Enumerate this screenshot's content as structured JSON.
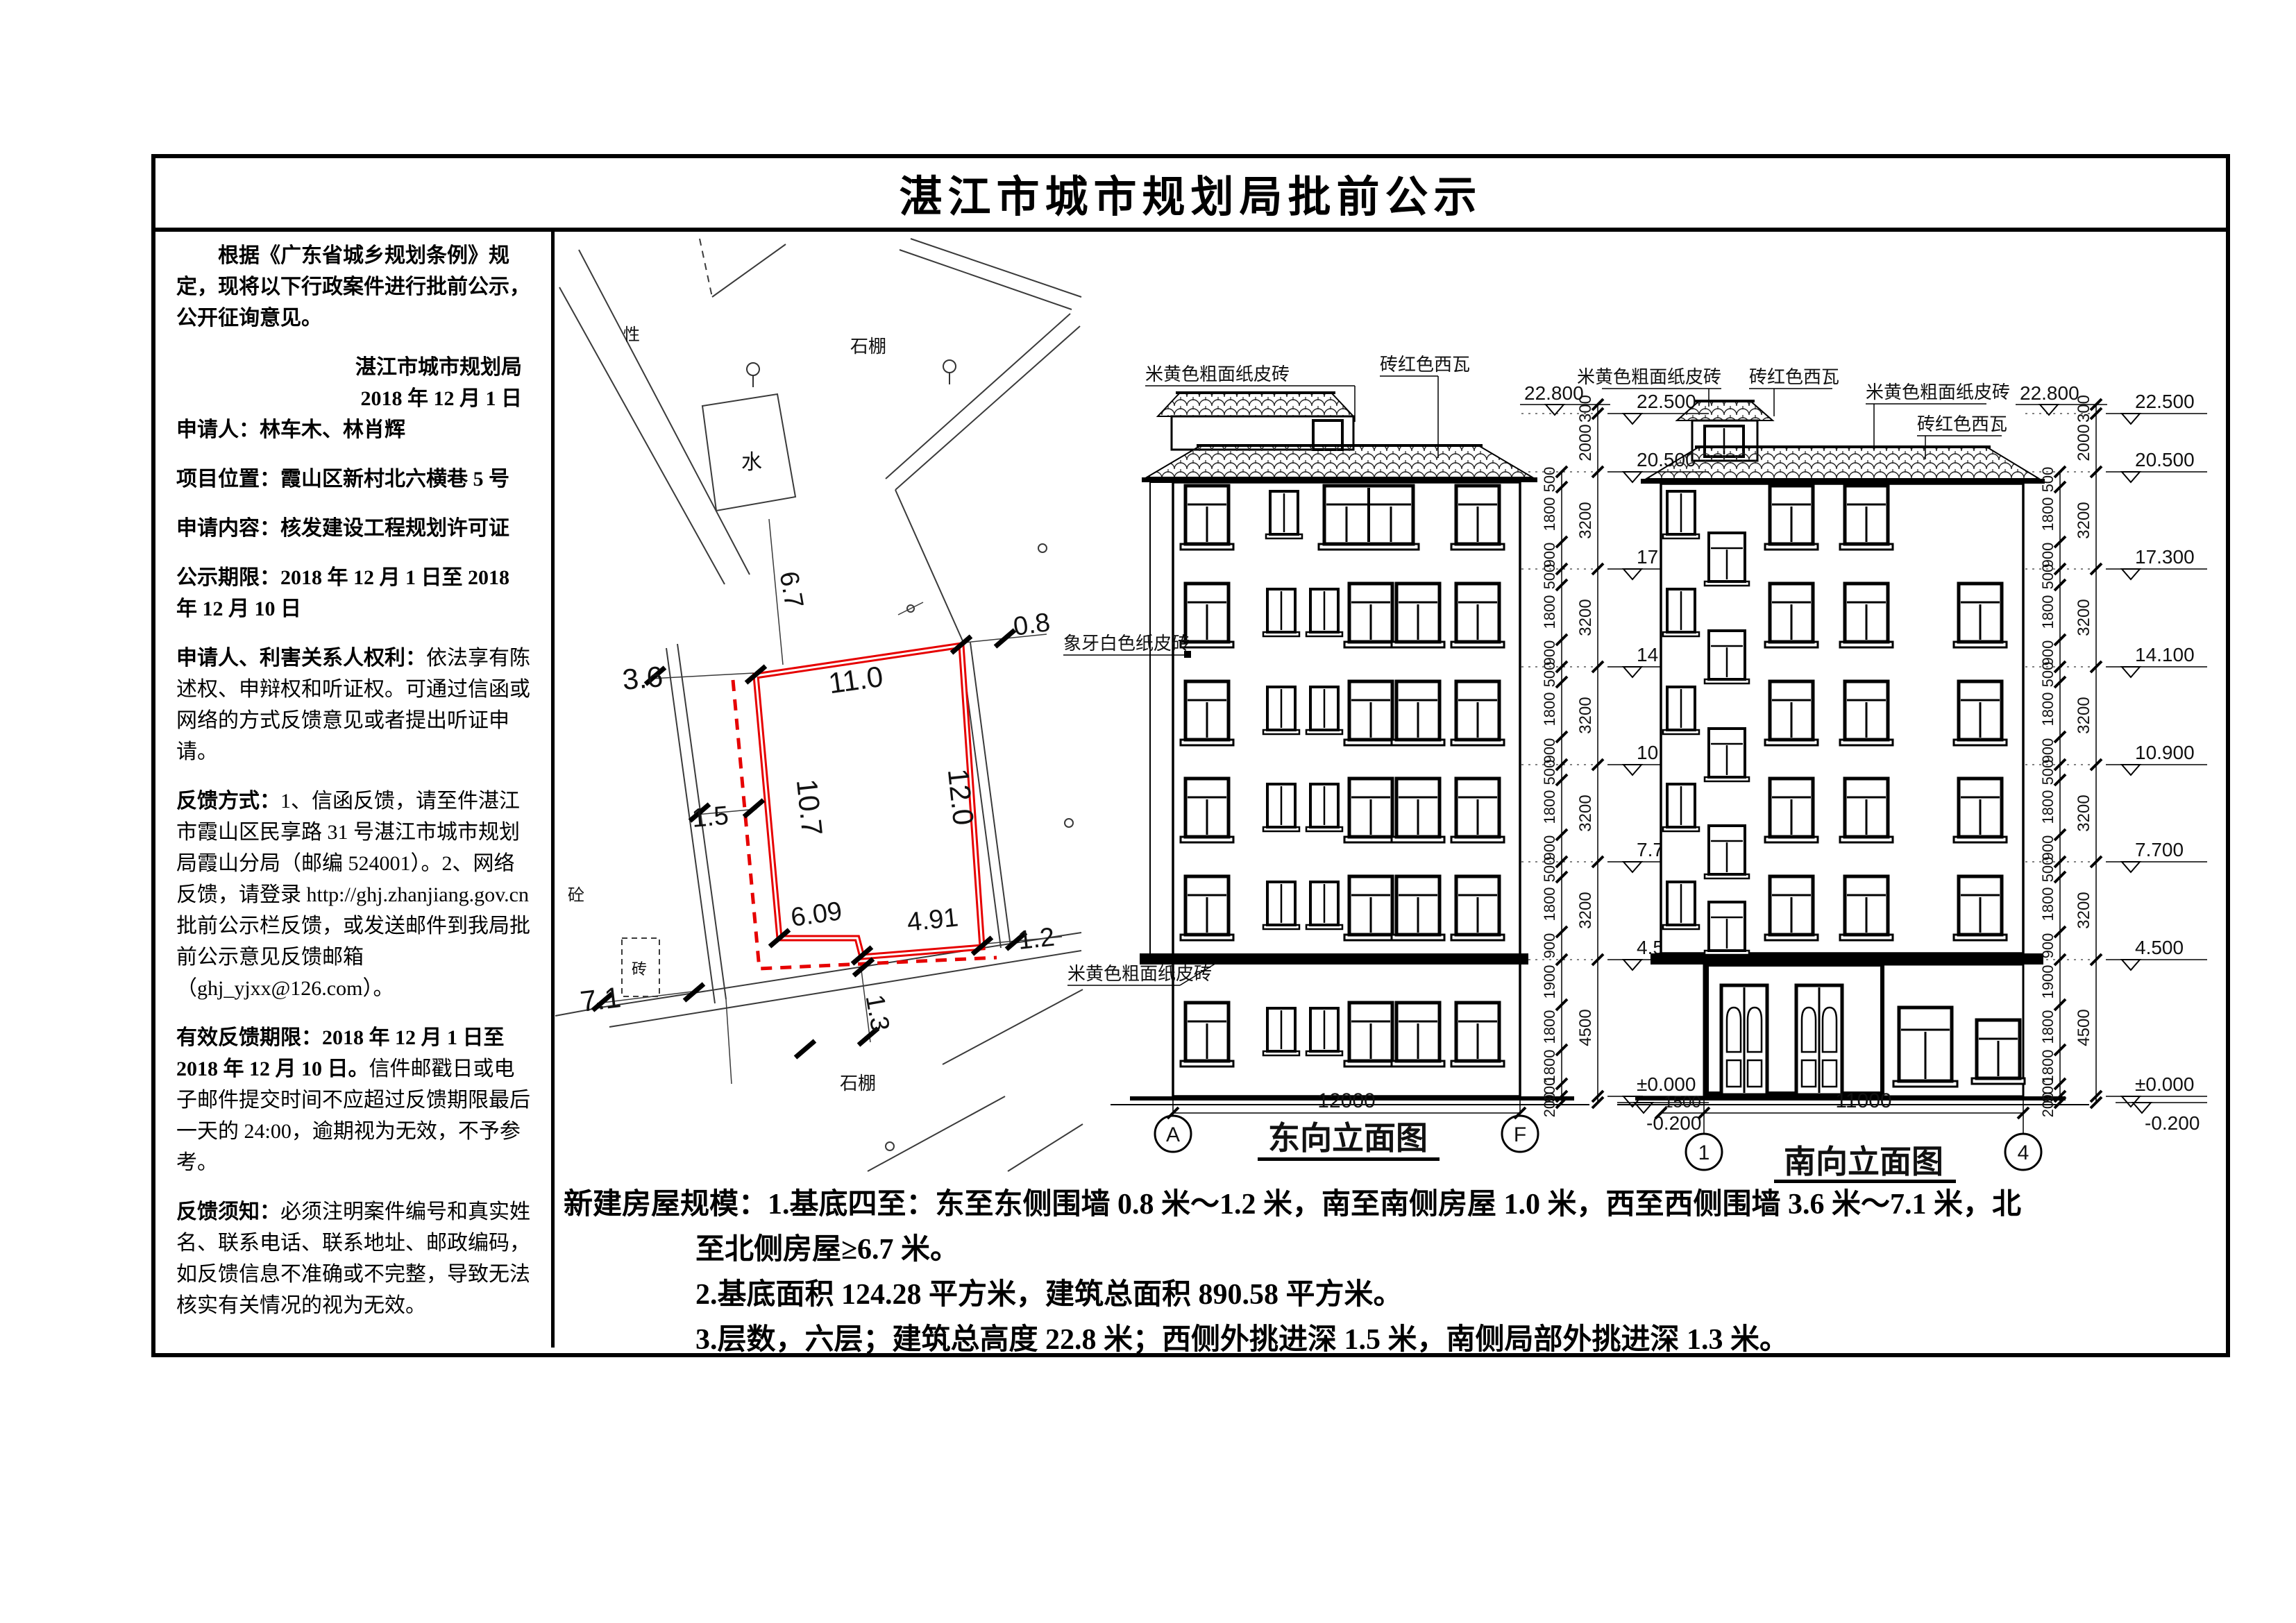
{
  "title": "湛江市城市规划局批前公示",
  "left_panel": {
    "intro": "根据《广东省城乡规划条例》规定，现将以下行政案件进行批前公示，公开征询意见。",
    "agency": "湛江市城市规划局",
    "date": "2018 年 12 月 1 日",
    "applicant_label": "申请人：",
    "applicant": "林车木、林肖辉",
    "location_label": "项目位置：",
    "location": "霞山区新村北六横巷 5 号",
    "content_label": "申请内容：",
    "content": "核发建设工程规划许可证",
    "period_label": "公示期限：",
    "period": "2018 年 12 月 1 日至 2018 年 12 月 10 日",
    "rights_label": "申请人、利害关系人权利：",
    "rights": "依法享有陈述权、申辩权和听证权。可通过信函或网络的方式反馈意见或者提出听证申请。",
    "feedback_label": "反馈方式：",
    "feedback": "1、信函反馈，请至件湛江市霞山区民享路 31 号湛江市城市规划局霞山分局（邮编 524001）。2、网络反馈，请登录 http://ghj.zhanjiang.gov.cn 批前公示栏反馈，或发送邮件到我局批前公示意见反馈邮箱（ghj_yjxx@126.com）。",
    "valid_label": "有效反馈期限：",
    "valid_dates": "2018 年 12 月 1 日至 2018 年 12 月 10 日。",
    "valid_rest": "信件邮戳日或电子邮件提交时间不应超过反馈期限最后一天的 24:00，逾期视为无效，不予参考。",
    "notice_label": "反馈须知：",
    "notice": "必须注明案件编号和真实姓名、联系电话、联系地址、邮政编码，如反馈信息不准确或不完整，导致无法核实有关情况的视为无效。"
  },
  "bottom": {
    "line1": "新建房屋规模：1.基底四至：东至东侧围墙 0.8 米～1.2 米，南至南侧房屋 1.0 米，西至西侧围墙 3.6 米～7.1 米，北",
    "line2": "至北侧房屋≥6.7 米。",
    "line3": "2.基底面积 124.28 平方米，建筑总面积 890.58 平方米。",
    "line4": "3.层数，六层；建筑总高度 22.8 米；西侧外挑进深 1.5 米，南侧局部外挑进深 1.3 米。"
  },
  "site_plan": {
    "plot_color": "#e60000",
    "dims": {
      "north_side": "11.0",
      "east_side": "12.0",
      "west_side": "10.7",
      "south_left": "6.09",
      "south_right": "4.91",
      "north_gap": "6.7",
      "east_gap1": "0.8",
      "east_gap2": "1.2",
      "west_gap1": "3.6",
      "west_gap2": "1.5",
      "west_gap3": "7.1",
      "south_gap": "1.3"
    },
    "labels": {
      "pond": "水",
      "shed_top": "石棚",
      "shed_bottom": "石棚",
      "stake": "性",
      "concrete": "砼",
      "brick": "砖"
    }
  },
  "elevation_dims": {
    "top_level": "22.800",
    "levels": [
      "22.500",
      "20.500",
      "17.300",
      "14.100",
      "10.900",
      "7.700",
      "4.500",
      "±0.000",
      "-0.200"
    ],
    "storey": [
      "300",
      "2000",
      "3200",
      "3200",
      "3200",
      "3200",
      "3200",
      "4500"
    ],
    "win": [
      "500",
      "1800",
      "900",
      "500",
      "1800",
      "900",
      "500",
      "1800",
      "900",
      "500",
      "1800",
      "900",
      "500",
      "1800",
      "900",
      "1900",
      "1800",
      "1800",
      "900",
      "200"
    ]
  },
  "east_elev": {
    "title": "东向立面图",
    "width_dim": "12000",
    "grid_left": "A",
    "grid_right": "F",
    "notes": {
      "roof_brick": "米黄色粗面纸皮砖",
      "roof_tile": "砖红色西瓦",
      "wall_brick": "象牙白色纸皮砖",
      "base_brick": "米黄色粗面纸皮砖"
    }
  },
  "south_elev": {
    "title": "南向立面图",
    "width_left": "1500",
    "width_main": "11000",
    "grid_left": "1",
    "grid_right": "4",
    "notes": {
      "pent_brick": "米黄色粗面纸皮砖",
      "pent_tile": "砖红色西瓦",
      "roof_brick": "米黄色粗面纸皮砖",
      "roof_tile": "砖红色西瓦"
    }
  }
}
